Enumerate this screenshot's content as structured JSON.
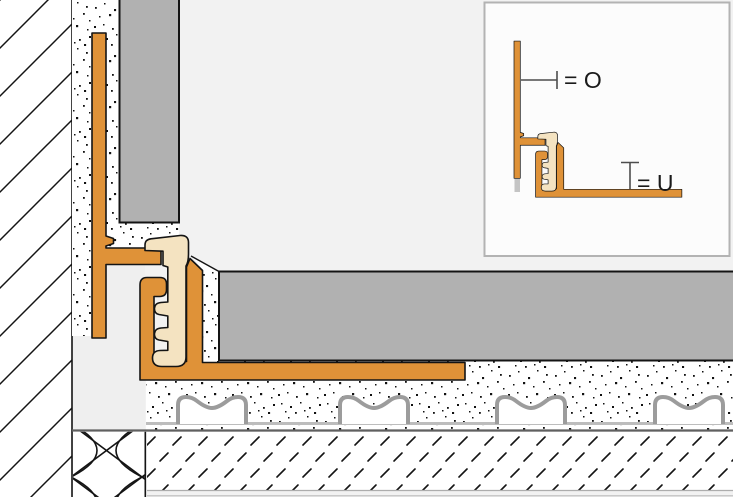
{
  "inset": {
    "label_o": "= O",
    "label_u": "= U"
  },
  "colors": {
    "profile_orange": "#DF9238",
    "insert_cream": "#F4E3C1",
    "tile_gray": "#B1B1B1",
    "room_background": "#F2F2F2",
    "plain_cavity_gray": "#EFEFEF",
    "membrane_gray": "#9C9C9C",
    "membrane_fleece_gray": "#BDBDBD",
    "screed_top_line_gray": "#606060",
    "outline_black": "#141414",
    "inset_background": "#FCFCFC",
    "inset_border_gray": "#B3B3B3",
    "dimension_gray": "#4D4D4D",
    "label_text": "#1A1A1A",
    "profile_shadow_gray": "#C4C4C4"
  }
}
